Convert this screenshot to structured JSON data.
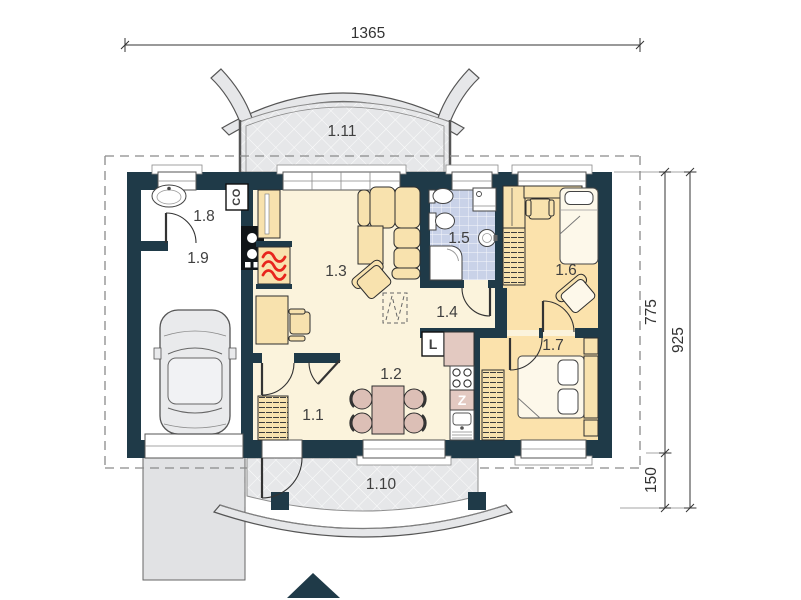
{
  "rooms": [
    {
      "label": "1.1"
    },
    {
      "label": "1.2"
    },
    {
      "label": "1.3"
    },
    {
      "label": "1.4"
    },
    {
      "label": "1.5"
    },
    {
      "label": "1.6"
    },
    {
      "label": "1.7"
    },
    {
      "label": "1.8"
    },
    {
      "label": "1.9"
    },
    {
      "label": "1.10"
    },
    {
      "label": "1.11"
    }
  ],
  "dimensions": {
    "width_total": "1365",
    "depth_house": "775",
    "depth_total": "925",
    "terrace_depth": "150"
  },
  "kitchen": {
    "fridge_label": "L",
    "sink_label": "Z"
  },
  "utility": {
    "boiler_label": "CO"
  },
  "colors": {
    "wall": "#1f3a48",
    "floor": "#fbf3dc",
    "bedroom": "#fbe2ac",
    "bath": "#c9d2e8",
    "terrace": "#e6e7e9",
    "furniture": "#f8e2ae",
    "rose": "#dcbfb6",
    "counter": "#e3c9c1",
    "red": "#e8251d",
    "car": "#e9eaec",
    "drive": "#e1e2e4",
    "creambed": "#fdf8ea",
    "ink": "#3f3f3f"
  }
}
